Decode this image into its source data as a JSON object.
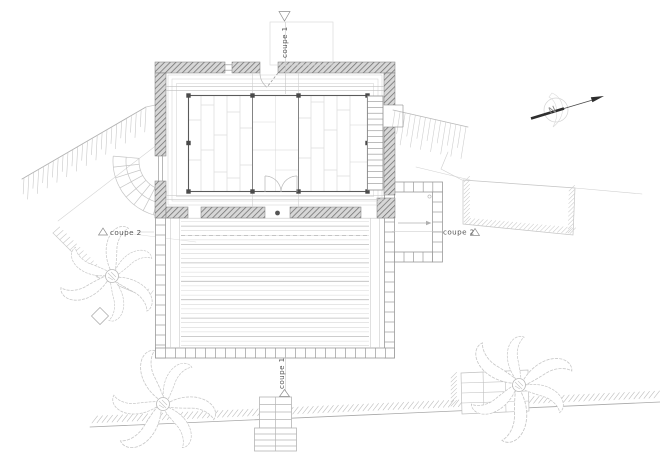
{
  "plan": {
    "sections": {
      "coupe1": "coupe 1",
      "coupe2": "coupe 2"
    },
    "compass": {
      "north": "N"
    },
    "icons": {
      "north-arrow": "arrow-northeast",
      "section-marker": "open-triangle",
      "palm-tree": "radial-fronds",
      "column-post": "filled-dot"
    },
    "colors": {
      "paper": "#ffffff",
      "wall_hatch_line": "#6f6f6f",
      "wall_hatch_bg": "#d7d7d7",
      "dark_line": "#4a4a4a",
      "room_outline": "#5a5a5a",
      "medium_line": "#999999",
      "light_line": "#c8c8c8",
      "faint_line": "#d8d8d8",
      "arrow_black": "#2e2e2e"
    }
  }
}
